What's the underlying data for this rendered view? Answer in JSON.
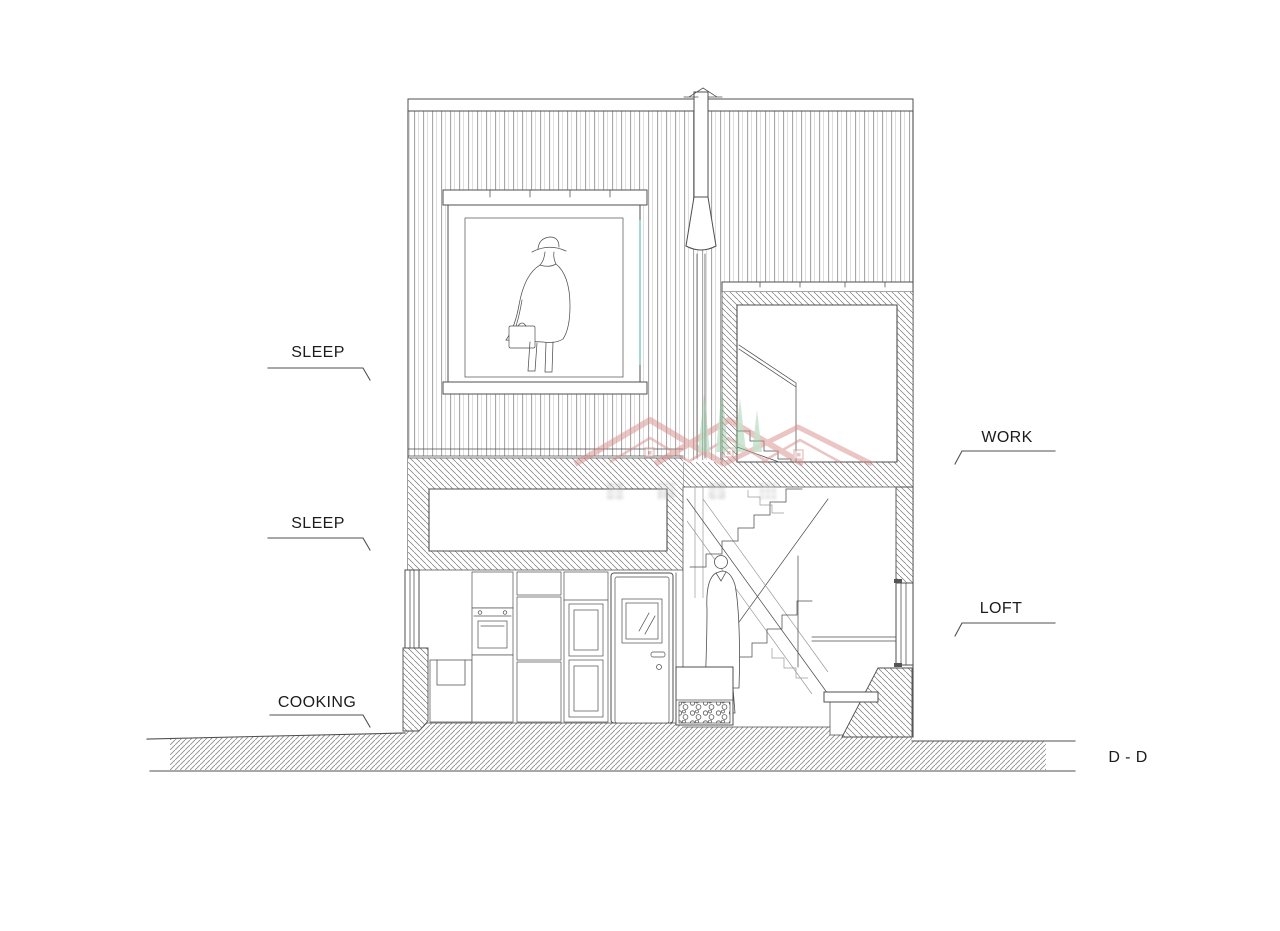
{
  "labels": {
    "sleep_upper": "SLEEP",
    "sleep_lower": "SLEEP",
    "cooking": "COOKING",
    "work": "WORK",
    "loft": "LOFT",
    "section_name": "D - D"
  },
  "watermark": {
    "description": "semi-transparent logo: red roofline peaks, green trees, four illegible CJK glyphs",
    "glyph_count": 4
  },
  "theme": {
    "line": "#4f4f4f",
    "line-light": "#9a9a9a",
    "siding": "#9f9f9f",
    "hatch": "#787878",
    "ground": "#8f8f8f",
    "glass-accent": "#79c9bd",
    "label-text": "#1c1c1c",
    "watermark-red": "#d98b8b",
    "watermark-green": "#8cc79a",
    "watermark-gray": "#8a8a8a",
    "paper": "#ffffff"
  }
}
